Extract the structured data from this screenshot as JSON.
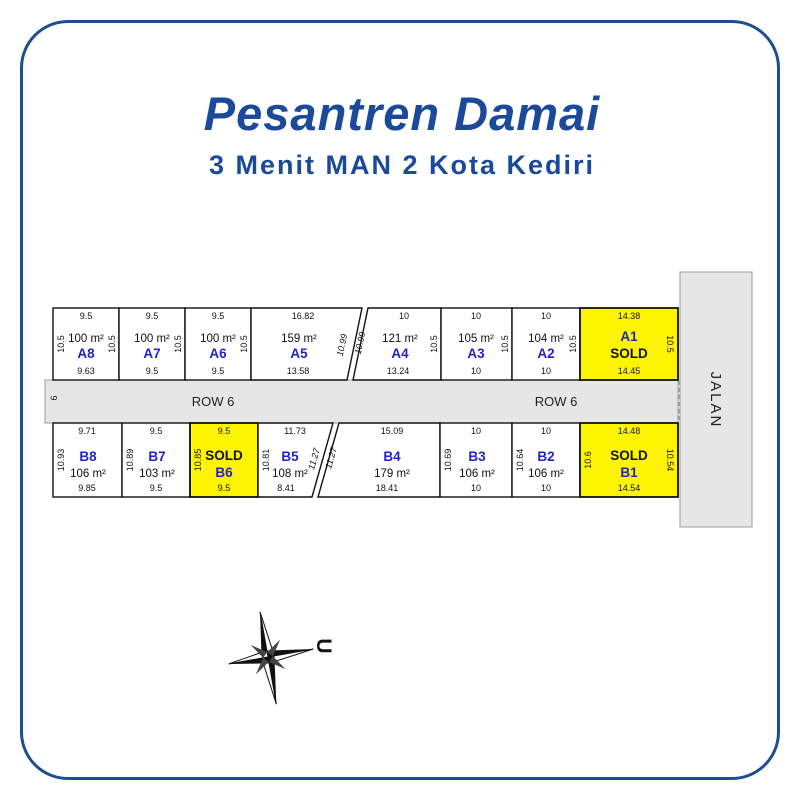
{
  "page": {
    "title": "Pesantren Damai",
    "subtitle": "3 Menit MAN 2 Kota Kediri"
  },
  "colors": {
    "accent_blue": "#1b4a9b",
    "border_blue": "#1d4e8f",
    "plot_label_blue": "#2323c8",
    "sold_yellow": "#fdf402",
    "road_gray": "#e6e6e6"
  },
  "roads": {
    "row6_label": "ROW 6",
    "row6_width": "6",
    "side_road_label": "JALAN"
  },
  "compass": {
    "north_label": "U"
  },
  "plots": {
    "a8": {
      "label": "A8",
      "area": "100 m²",
      "status": "",
      "dim_top": "9.5",
      "dim_bottom": "9.63",
      "dim_left": "10.5",
      "dim_right": "10.5"
    },
    "a7": {
      "label": "A7",
      "area": "100 m²",
      "status": "",
      "dim_top": "9.5",
      "dim_bottom": "9.5",
      "dim_right": "10.5"
    },
    "a6": {
      "label": "A6",
      "area": "100 m²",
      "status": "",
      "dim_top": "9.5",
      "dim_bottom": "9.5",
      "dim_right": "10.5"
    },
    "a5": {
      "label": "A5",
      "area": "159 m²",
      "status": "",
      "dim_top": "16.82",
      "dim_bottom": "13.58",
      "dim_slant_right": "10.99"
    },
    "a4": {
      "label": "A4",
      "area": "121 m²",
      "status": "",
      "dim_top": "10",
      "dim_bottom": "13.24",
      "dim_slant_left": "10.99",
      "dim_right": "10.5"
    },
    "a3": {
      "label": "A3",
      "area": "105 m²",
      "status": "",
      "dim_top": "10",
      "dim_bottom": "10",
      "dim_right": "10.5"
    },
    "a2": {
      "label": "A2",
      "area": "104 m²",
      "status": "",
      "dim_top": "10",
      "dim_bottom": "10",
      "dim_right": "10.5"
    },
    "a1": {
      "label": "A1",
      "area": "",
      "status": "SOLD",
      "dim_top": "14.38",
      "dim_bottom": "14.45",
      "dim_right": "10.5"
    },
    "b8": {
      "label": "B8",
      "area": "106 m²",
      "status": "",
      "dim_top": "9.71",
      "dim_bottom": "9.85",
      "dim_left": "10.93"
    },
    "b7": {
      "label": "B7",
      "area": "103 m²",
      "status": "",
      "dim_top": "9.5",
      "dim_bottom": "9.5",
      "dim_left": "10.89"
    },
    "b6": {
      "label": "B6",
      "area": "",
      "status": "SOLD",
      "dim_top": "9.5",
      "dim_bottom": "9.5",
      "dim_left": "10.85"
    },
    "b5": {
      "label": "B5",
      "area": "108 m²",
      "status": "",
      "dim_top": "11.73",
      "dim_bottom": "8.41",
      "dim_left": "10.81",
      "dim_slant_right": "11.27"
    },
    "b4": {
      "label": "B4",
      "area": "179 m²",
      "status": "",
      "dim_top": "15.09",
      "dim_bottom": "18.41",
      "dim_slant_left": "11.27"
    },
    "b3": {
      "label": "B3",
      "area": "106 m²",
      "status": "",
      "dim_top": "10",
      "dim_bottom": "10",
      "dim_left": "10.69"
    },
    "b2": {
      "label": "B2",
      "area": "106 m²",
      "status": "",
      "dim_top": "10",
      "dim_bottom": "10",
      "dim_left": "10.64"
    },
    "b1": {
      "label": "B1",
      "area": "",
      "status": "SOLD",
      "dim_top": "14.48",
      "dim_bottom": "14.54",
      "dim_left": "10.6",
      "dim_right": "10.54"
    }
  }
}
